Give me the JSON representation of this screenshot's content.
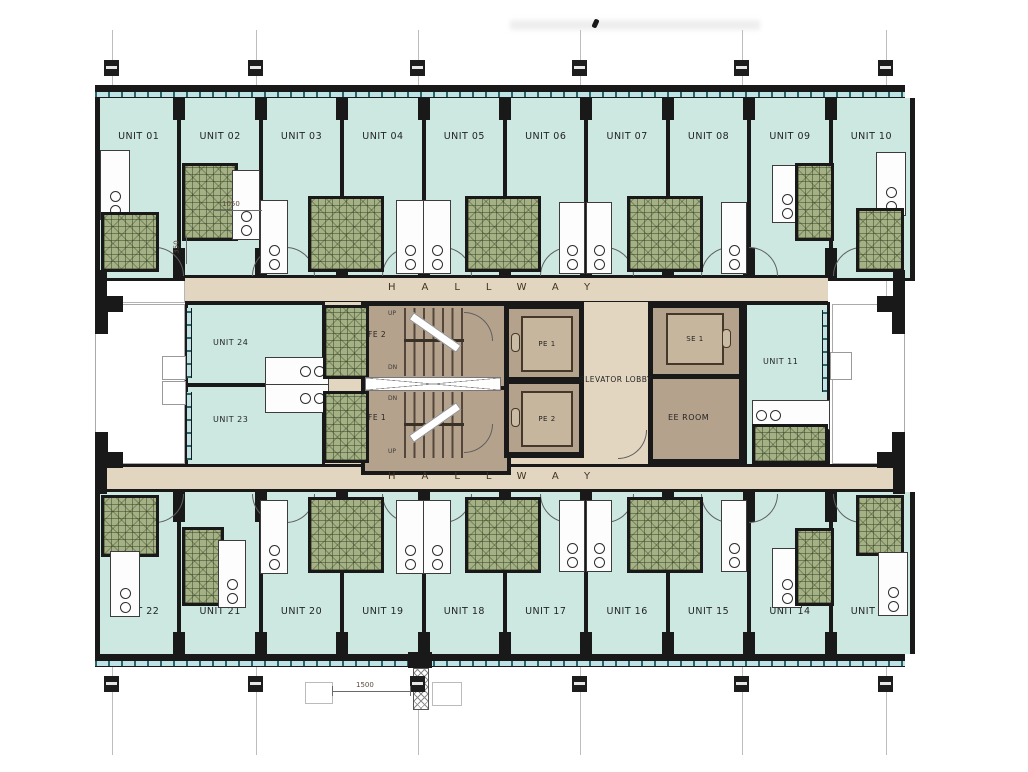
{
  "plan": {
    "hallway_top": "HALLWAY",
    "hallway_bottom": "HALLWAY",
    "elevator_lobby": "ELEVATOR LOBBY",
    "ee_room": "EE ROOM",
    "stair_upper": "FE 2",
    "stair_lower": "FE 1",
    "elevator_1": "PE 1",
    "elevator_2": "PE 2",
    "service_elevator": "SE 1",
    "up_label": "UP",
    "down_label": "DN",
    "units_top": [
      "UNIT 01",
      "UNIT 02",
      "UNIT 03",
      "UNIT 04",
      "UNIT 05",
      "UNIT 06",
      "UNIT 07",
      "UNIT 08",
      "UNIT 09",
      "UNIT 10"
    ],
    "units_bottom": [
      "UNIT 22",
      "UNIT 21",
      "UNIT 20",
      "UNIT 19",
      "UNIT 18",
      "UNIT 17",
      "UNIT 16",
      "UNIT 15",
      "UNIT 14",
      "UNIT 12"
    ],
    "unit_west_upper": "UNIT 24",
    "unit_west_lower": "UNIT 23",
    "unit_east": "UNIT 11",
    "dimensions": {
      "kitchen": "1050",
      "wall": "350",
      "bay": "1500"
    },
    "colors": {
      "unit_fill": "#cde8e1",
      "hallway_fill": "#e3d6c0",
      "core_fill": "#b5a28c",
      "bath_tile": "#a3b184",
      "wall": "#191919",
      "window": "#bfe3e4"
    }
  }
}
